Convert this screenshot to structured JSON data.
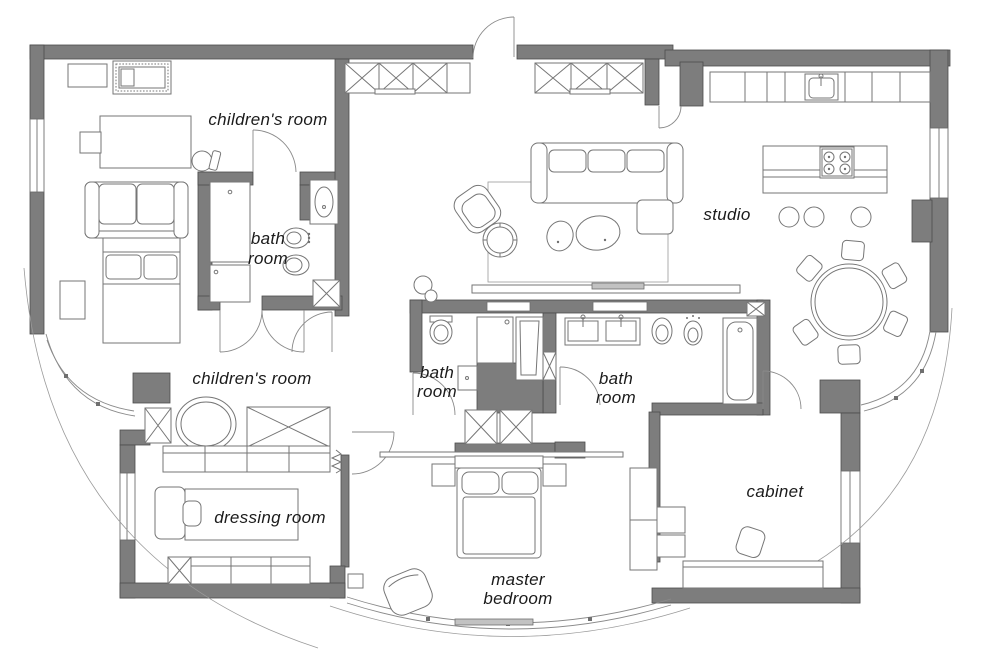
{
  "theme": {
    "wall_fill": "#7d7d7d",
    "wall_stroke": "#4c4c4c",
    "furniture_line": "#767676",
    "thin_line": "#9a9a9a",
    "label_color": "#1b1b1b",
    "background": "#ffffff"
  },
  "plan": {
    "type": "apartment-floor-plan",
    "rooms": [
      {
        "id": "children-room-1",
        "lines": [
          "children's room"
        ]
      },
      {
        "id": "bath-room-1",
        "lines": [
          "bath",
          "room"
        ]
      },
      {
        "id": "children-room-2",
        "lines": [
          "children's room"
        ]
      },
      {
        "id": "dressing-room",
        "lines": [
          "dressing room"
        ]
      },
      {
        "id": "studio",
        "lines": [
          "studio"
        ]
      },
      {
        "id": "bath-room-2",
        "lines": [
          "bath",
          "room"
        ]
      },
      {
        "id": "bath-room-3",
        "lines": [
          "bath",
          "room"
        ]
      },
      {
        "id": "cabinet",
        "lines": [
          "cabinet"
        ]
      },
      {
        "id": "master-bedroom",
        "lines": [
          "master",
          "bedroom"
        ]
      }
    ]
  }
}
